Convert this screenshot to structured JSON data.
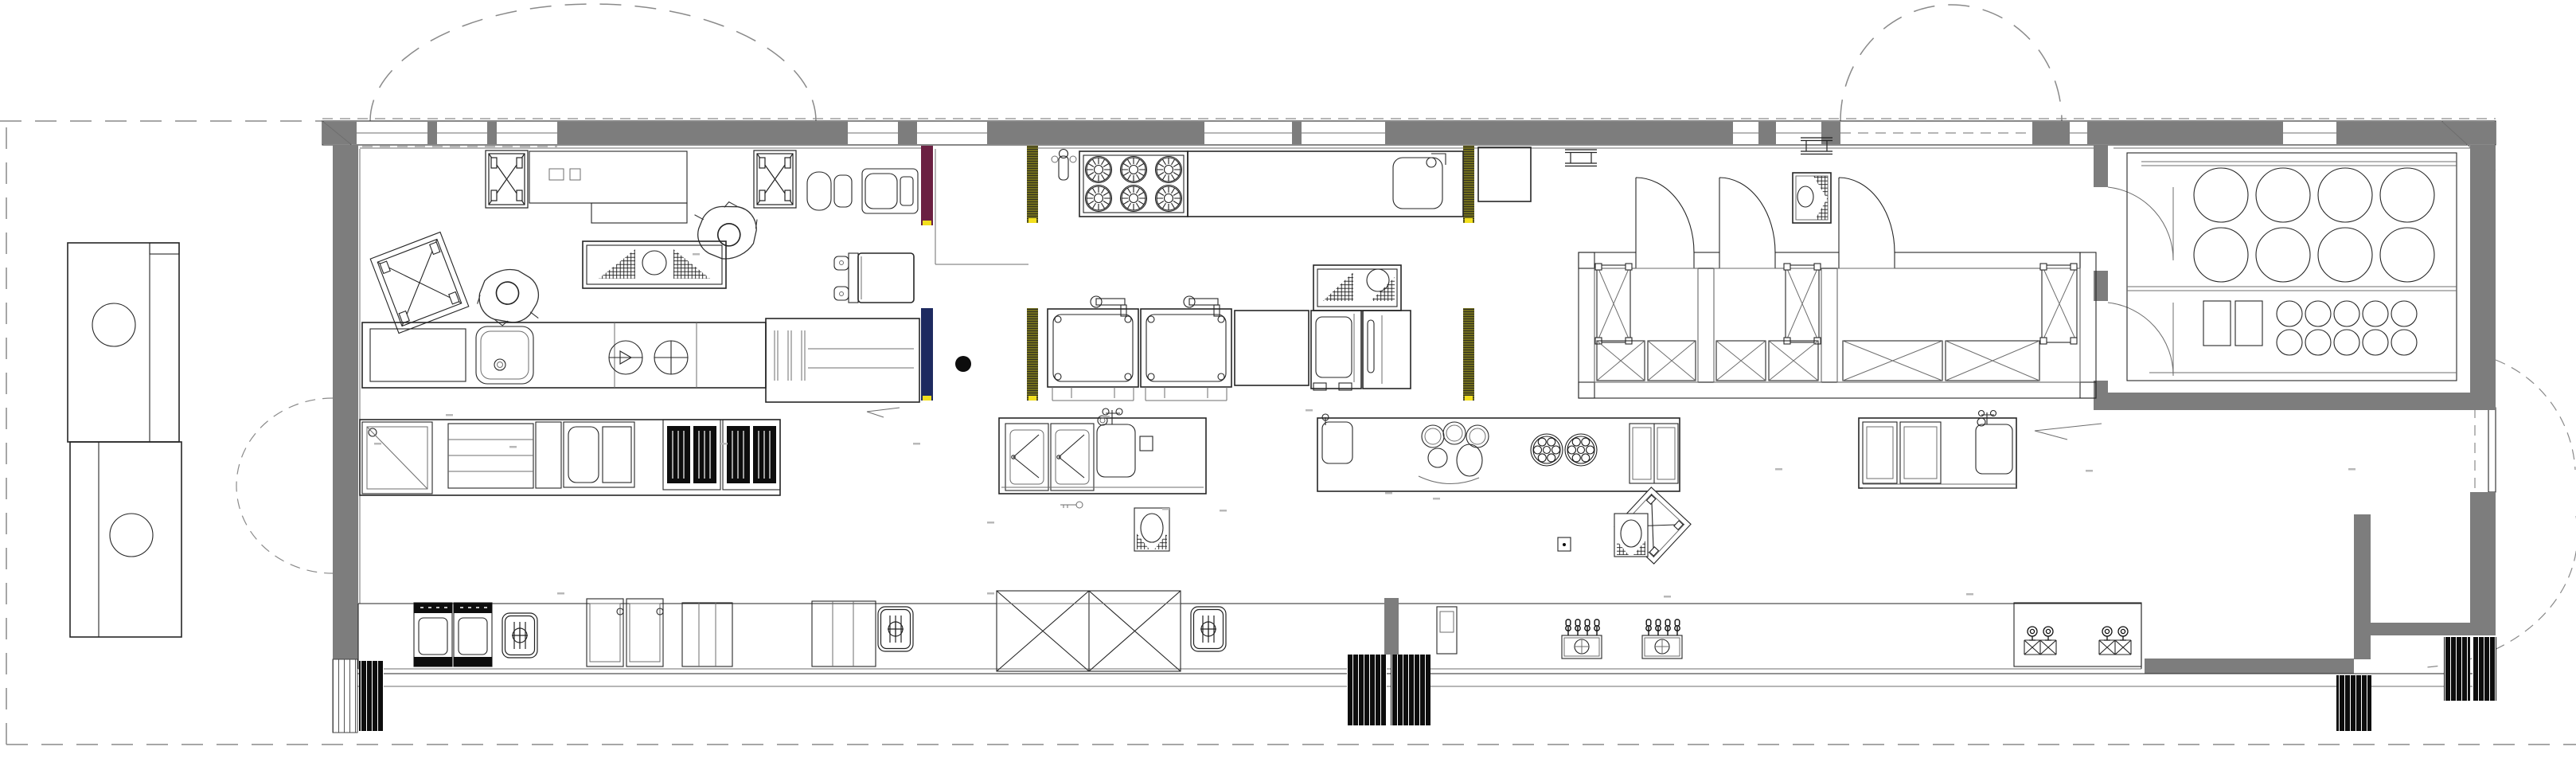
{
  "document": {
    "type": "architectural floor plan",
    "subject": "Long narrow commercial kitchen and service bar — plan view line drawing, no readable text labels"
  },
  "colors": {
    "paper": "#ffffff",
    "wall": "#7d7d7d",
    "line": "#262626",
    "thin": "#6e6e6e",
    "dash": "#8a8a8a",
    "maroon": "#6b2042",
    "navy": "#1d2a60",
    "olive": "#716d1c",
    "olive2": "#6f5a15",
    "yellow": "#f2df1f",
    "mat": "#0d0d0d",
    "label": "#b8b8b8"
  },
  "rooms": [
    {
      "name": "Prep kitchen"
    },
    {
      "name": "Cooking line"
    },
    {
      "name": "Warewash / pot wash"
    },
    {
      "name": "Walk-in cold rooms",
      "compartments": 3,
      "doors": 3,
      "wire_shelves": 9
    },
    {
      "name": "Tank and keg storage room",
      "large_tanks": 8,
      "kegs": 10,
      "crates": 2
    },
    {
      "name": "Service bar counter"
    },
    {
      "name": "Outdoor walkway / site boundary"
    }
  ],
  "equipment": {
    "prep_kitchen": [
      "X-frame mobile table",
      "X-frame mobile table",
      "wall work counter",
      "meat slicer",
      "stand mixer",
      "prep table with hatch boards and bowl",
      "counter with sink",
      "two counter hobs",
      "worker figure",
      "worker figure",
      "tilted X-frame table"
    ],
    "cooking_line": [
      "hand sink",
      "6-burner range",
      "counter with pot sink",
      "steam kettle",
      "steam kettle",
      "landing table",
      "combi oven",
      "holding cabinet",
      "pot table with hatch board and bowl"
    ],
    "warewash": [
      "under-counter cabinet with doors",
      "wash sink with faucet",
      "waste bin",
      "key drop",
      "waste bin 2"
    ],
    "bar": [
      "storage cabinet",
      "open shelf unit",
      "pan and perforated insert station",
      "bottle cooler (black doors)",
      "bottle cooler (black doors)",
      "refrigerated display case",
      "refrigerated display case",
      "drop-in dump sink",
      "drop-in dump sink",
      "drop-in dump sink",
      "double X pass table",
      "POS tower",
      "beer tap station",
      "beer tap station",
      "espresso station",
      "espresso station",
      "steamer ring station",
      "burner plate",
      "burner plate",
      "back-bar sink",
      "back-bar cabinets"
    ],
    "site": [
      "external storage unit with round hatch",
      "external storage unit with round hatch",
      "structural column (filled dot)",
      "entry mats (striped)"
    ]
  },
  "counts": {
    "range_burners": 6,
    "walkin_doors": 3,
    "tank_room_doors": 2,
    "beer_taps_per_station": 4,
    "entry_mat_groups": 4,
    "large_tanks": 8,
    "kegs": 10,
    "exterior_swing_arcs": 5,
    "worker_figures": 2
  },
  "wall_finish_markers": [
    {
      "color_key": "maroon"
    },
    {
      "color_key": "navy"
    },
    {
      "color_key": "olive"
    },
    {
      "color_key": "olive"
    },
    {
      "color_key": "olive"
    },
    {
      "color_key": "olive"
    }
  ]
}
